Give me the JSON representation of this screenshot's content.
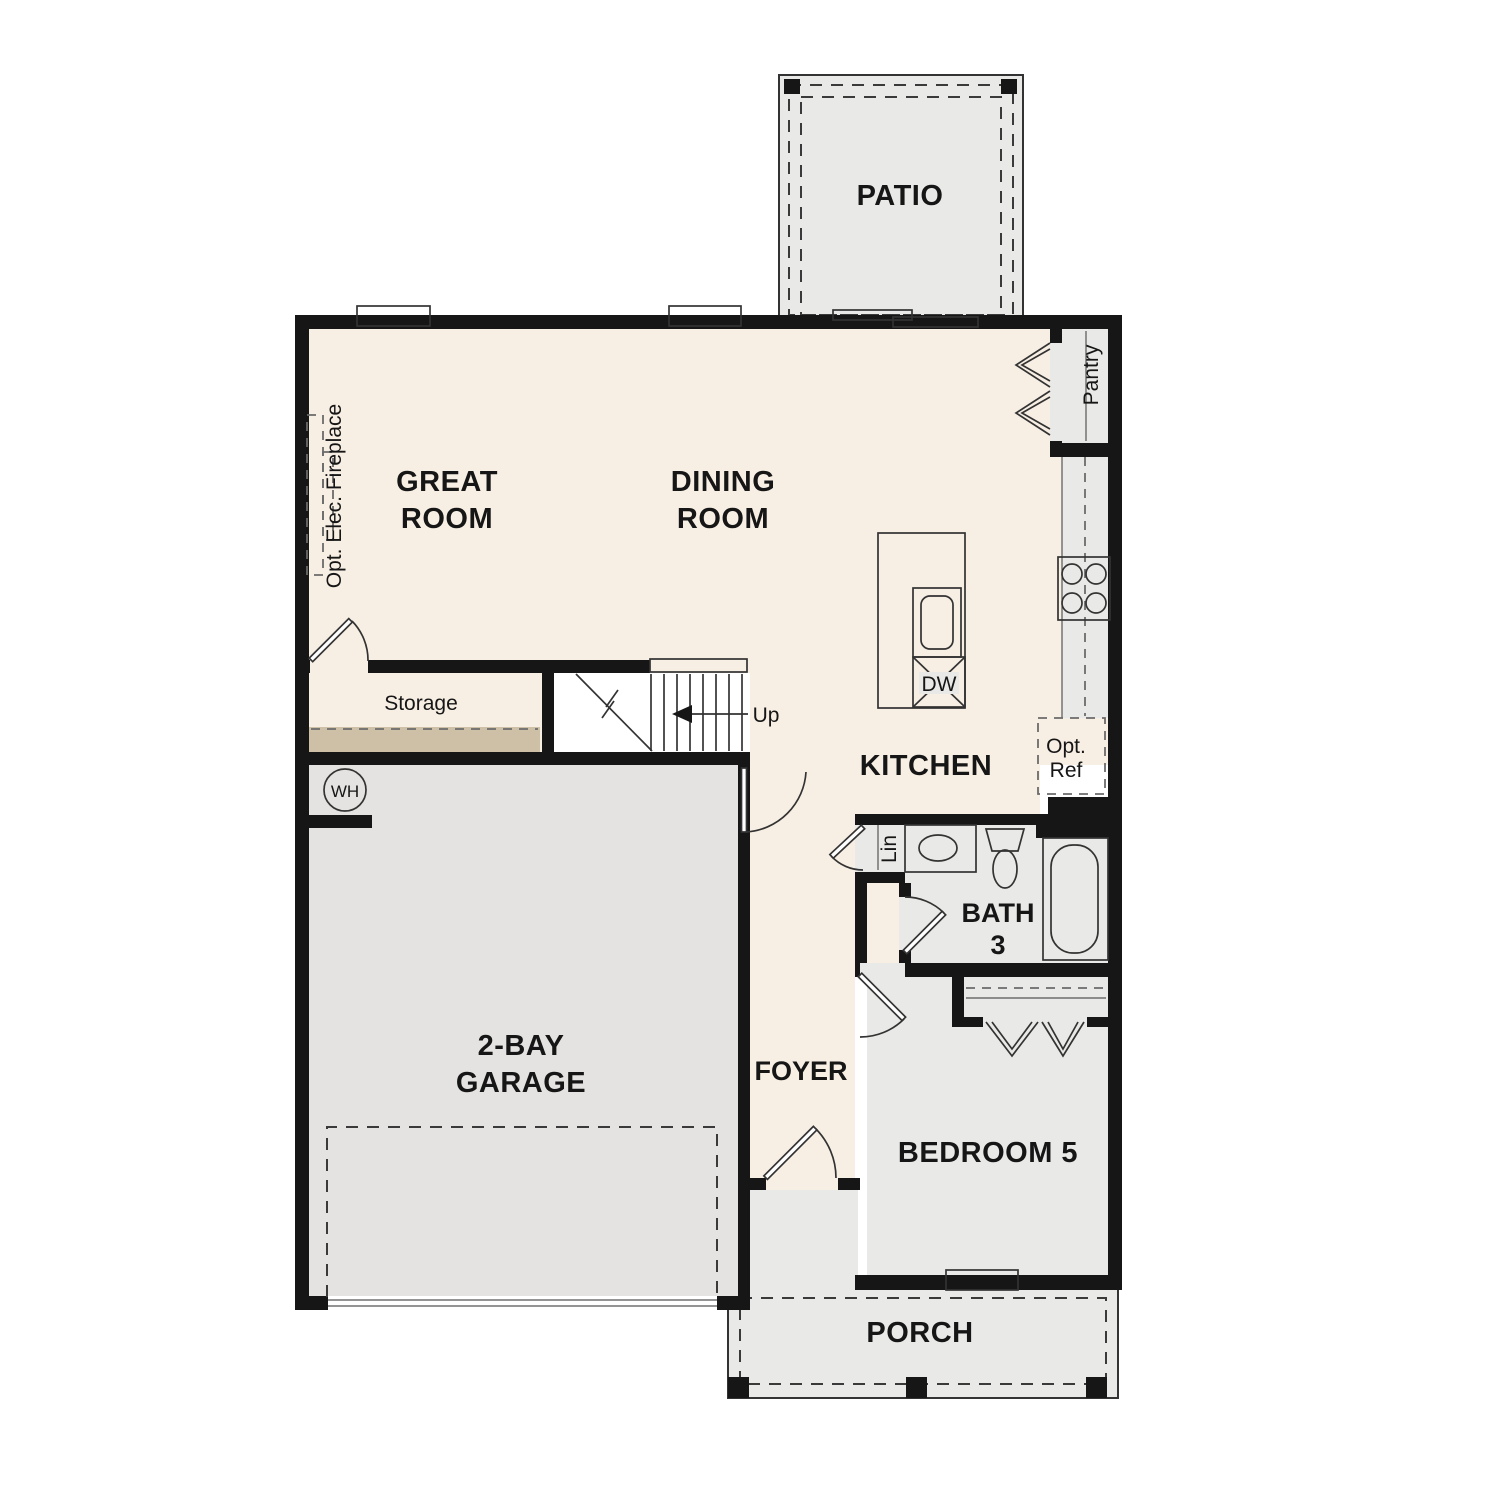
{
  "colors": {
    "wall": "#161616",
    "floor-cream": "#f8efe4",
    "room-gray": "#e9e9e7",
    "garage-gray": "#e4e3e1",
    "accent-tan": "#cdc0a7",
    "line": "#333333",
    "text": "#161616"
  },
  "rooms": {
    "patio": {
      "label": "PATIO"
    },
    "great_room": {
      "lines": [
        "GREAT",
        "ROOM"
      ]
    },
    "dining_room": {
      "lines": [
        "DINING",
        "ROOM"
      ]
    },
    "kitchen": {
      "label": "KITCHEN"
    },
    "pantry": {
      "label": "Pantry"
    },
    "storage": {
      "label": "Storage"
    },
    "garage": {
      "lines": [
        "2-BAY",
        "GARAGE"
      ]
    },
    "foyer": {
      "label": "FOYER"
    },
    "bath_3": {
      "lines": [
        "BATH",
        "3"
      ]
    },
    "bedroom_5": {
      "label": "BEDROOM 5"
    },
    "porch": {
      "label": "PORCH"
    },
    "linen": {
      "label": "Lin"
    }
  },
  "annotations": {
    "stairs_direction": "Up",
    "water_heater": "WH",
    "dishwasher": "DW",
    "optional_refrigerator": {
      "lines": [
        "Opt.",
        "Ref"
      ]
    },
    "optional_fireplace": "Opt. Elec. Fireplace"
  }
}
